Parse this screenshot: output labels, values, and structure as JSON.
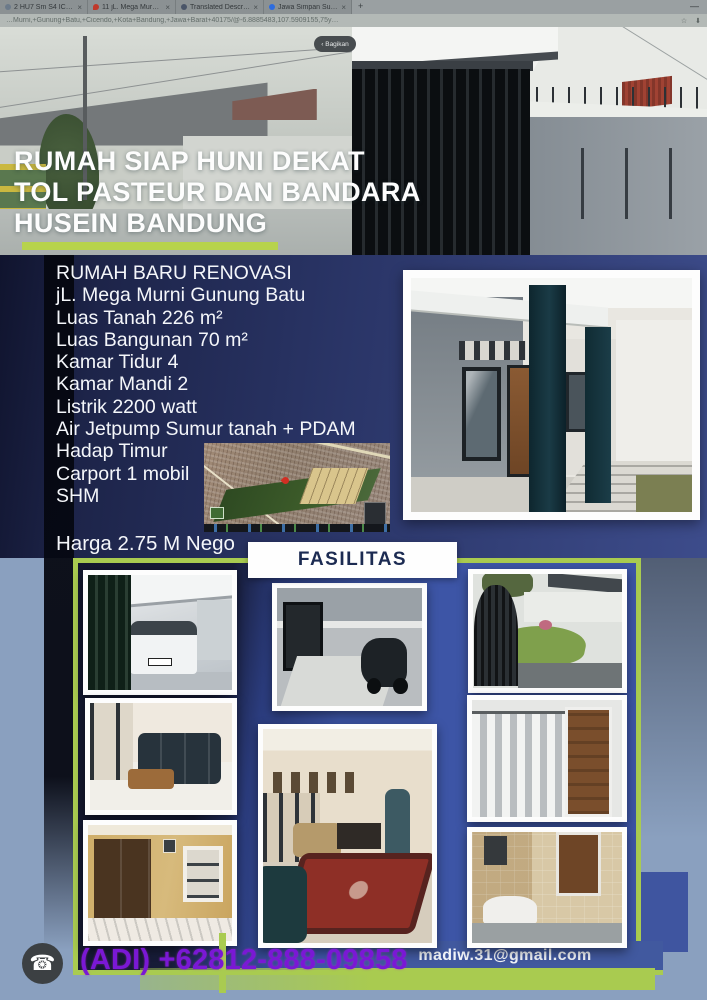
{
  "browser": {
    "tabs": [
      {
        "label": "2 HU7 Sm S4 ICB…"
      },
      {
        "label": "11 jL. Mega Murni…"
      },
      {
        "label": "Translated Descri…"
      },
      {
        "label": "Jawa Simpan Sur…"
      }
    ],
    "close_glyph": "×",
    "new_tab_glyph": "+",
    "minimize_glyph": "—",
    "url_text": "…Murni,+Gunung+Batu,+Cicendo,+Kota+Bandung,+Jawa+Barat+40175/@-6.8885483,107.5909155,75y…",
    "star_glyph": "☆",
    "download_glyph": "⬇",
    "share_label": "‹ Bagikan"
  },
  "hero": {
    "title_line1": "RUMAH SIAP HUNI DEKAT",
    "title_line2": "TOL PASTEUR DAN BANDARA",
    "title_line3": "HUSEIN BANDUNG"
  },
  "details": {
    "lines": [
      "RUMAH BARU RENOVASI",
      "jL. Mega Murni Gunung Batu",
      "Luas Tanah 226 m²",
      "Luas Bangunan 70 m²",
      "Kamar Tidur 4",
      "Kamar Mandi 2",
      "Listrik 2200 watt",
      "Air Jetpump Sumur tanah + PDAM",
      "Hadap Timur",
      "Carport 1 mobil",
      "SHM"
    ],
    "price": "Harga 2.75 M Nego"
  },
  "sections": {
    "fasilitas_label": "FASILITAS"
  },
  "contact": {
    "phone": "(ADI) +62812-888-09858",
    "email": "madiw.31@gmail.com",
    "phone_icon_glyph": "☎"
  },
  "colors": {
    "accent_lime": "#a9cb50",
    "panel_blue": "#3d55a6",
    "body_navy": "#2a3567",
    "phone_purple": "#7a18d5",
    "footer_gray": "#8aa0bf",
    "email_band_blue": "#41599f"
  }
}
